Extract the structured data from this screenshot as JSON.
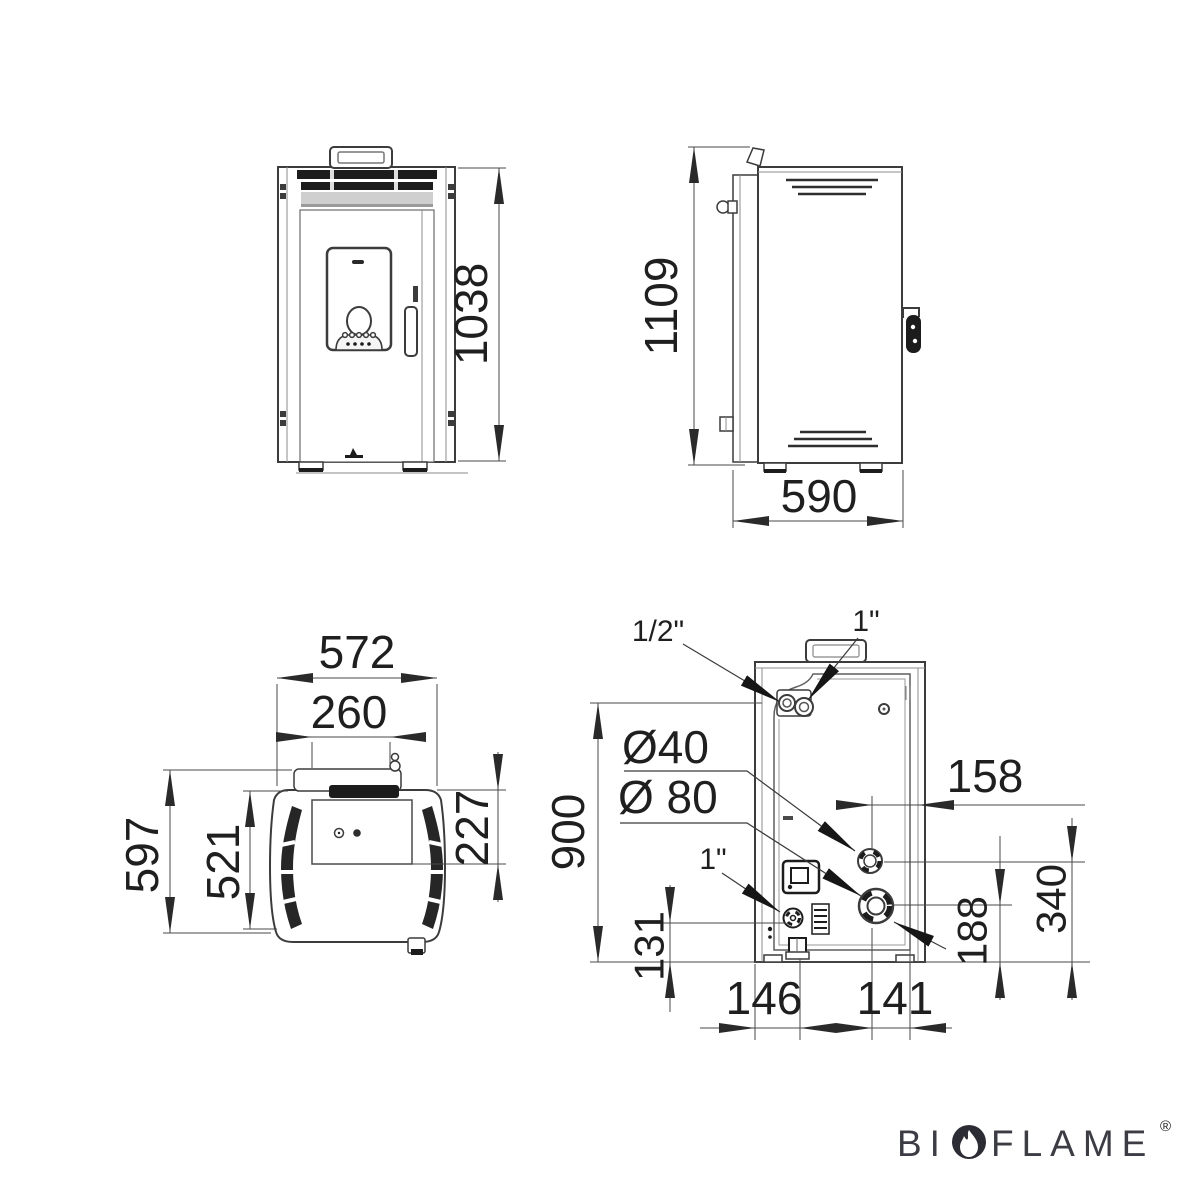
{
  "drawing": {
    "front_view": {
      "overall_height": "1038"
    },
    "side_view": {
      "overall_height": "1109",
      "overall_depth": "590"
    },
    "top_view": {
      "overall_width": "572",
      "lid_width": "260",
      "overall_depth": "597",
      "body_depth": "521",
      "panel_depth": "227"
    },
    "rear_view": {
      "height_to_connector": "900",
      "connector_top_left": "1/2\"",
      "connector_top": "1\"",
      "connector_bottom": "1\"",
      "smoke_outlet_diameter": "Ø40",
      "air_intake_diameter": "Ø 80",
      "offset_right": "158",
      "valve_height": "131",
      "offset_bottom_left": "146",
      "offset_bottom_right": "141",
      "air_intake_height": "188",
      "smoke_outlet_height": "340"
    }
  },
  "brand": {
    "prefix": "BI",
    "suffix": "FLAME",
    "registered": "®"
  }
}
